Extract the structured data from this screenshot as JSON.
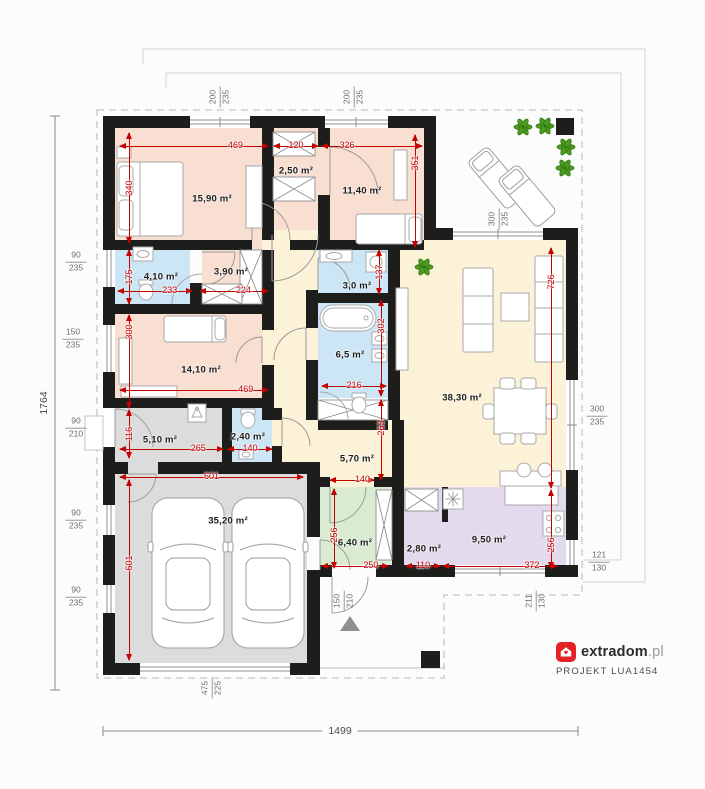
{
  "branding": {
    "name_bold": "extradom",
    "name_light": ".pl",
    "project": "PROJEKT LUA1454"
  },
  "overall": {
    "height": "1764",
    "width": "1499"
  },
  "colors": {
    "wall": "#1d1d1b",
    "dim_red": "#c40000",
    "label_gray": "#6e6e6e",
    "pink": "#f9ded2",
    "blue": "#cde6f6",
    "cream": "#fbf2d8",
    "gray": "#dcdcdc",
    "green": "#d9ecd2",
    "purple": "#e3daee",
    "brand_red": "#e32226"
  },
  "rooms": [
    {
      "id": "bedroom-1",
      "label": "15,90 m²",
      "fill": "pink",
      "x": 115,
      "y": 128,
      "w": 150,
      "h": 112,
      "lx": 212,
      "ly": 199
    },
    {
      "id": "wardrobe-1",
      "label": "2,50 m²",
      "fill": "pink",
      "x": 274,
      "y": 128,
      "w": 44,
      "h": 107,
      "lx": 296,
      "ly": 171
    },
    {
      "id": "bedroom-2",
      "label": "11,40 m²",
      "fill": "pink",
      "x": 318,
      "y": 128,
      "w": 106,
      "h": 112,
      "lx": 362,
      "ly": 191
    },
    {
      "id": "bathroom-1",
      "label": "4,10 m²",
      "fill": "blue",
      "x": 115,
      "y": 250,
      "w": 75,
      "h": 54,
      "lx": 161,
      "ly": 277
    },
    {
      "id": "wardrobe-2",
      "label": "3,90 m²",
      "fill": "pink",
      "x": 202,
      "y": 238,
      "w": 60,
      "h": 66,
      "lx": 231,
      "ly": 272
    },
    {
      "id": "bathroom-2",
      "label": "3,0 m²",
      "fill": "blue",
      "x": 318,
      "y": 250,
      "w": 70,
      "h": 43,
      "lx": 357,
      "ly": 286
    },
    {
      "id": "bedroom-3",
      "label": "14,10 m²",
      "fill": "pink",
      "x": 115,
      "y": 314,
      "w": 147,
      "h": 84,
      "lx": 201,
      "ly": 370
    },
    {
      "id": "bathroom-3",
      "label": "6,5 m²",
      "fill": "blue",
      "x": 318,
      "y": 303,
      "w": 70,
      "h": 95,
      "lx": 350,
      "ly": 355
    },
    {
      "id": "hallway",
      "label": "",
      "fill": "cream",
      "x": 262,
      "y": 230,
      "w": 56,
      "h": 195,
      "lx": 0,
      "ly": 0
    },
    {
      "id": "hall",
      "label": "5,70 m²",
      "fill": "cream",
      "x": 272,
      "y": 420,
      "w": 132,
      "h": 67,
      "lx": 357,
      "ly": 459
    },
    {
      "id": "living-room",
      "label": "38,30 m²",
      "fill": "cream",
      "x": 390,
      "y": 240,
      "w": 176,
      "h": 247,
      "lx": 462,
      "ly": 398
    },
    {
      "id": "corridor-garage",
      "label": "5,10 m²",
      "fill": "gray",
      "x": 115,
      "y": 408,
      "w": 110,
      "h": 54,
      "lx": 160,
      "ly": 440
    },
    {
      "id": "wc",
      "label": "2,40 m²",
      "fill": "blue",
      "x": 225,
      "y": 408,
      "w": 47,
      "h": 54,
      "lx": 248,
      "ly": 437
    },
    {
      "id": "garage",
      "label": "35,20 m²",
      "fill": "gray",
      "x": 115,
      "y": 462,
      "w": 192,
      "h": 201,
      "lx": 228,
      "ly": 521
    },
    {
      "id": "vestibule",
      "label": "6,40 m²",
      "fill": "green",
      "x": 320,
      "y": 487,
      "w": 78,
      "h": 78,
      "lx": 355,
      "ly": 543
    },
    {
      "id": "pantry",
      "label": "2,80 m²",
      "fill": "purple",
      "x": 404,
      "y": 487,
      "w": 38,
      "h": 78,
      "lx": 424,
      "ly": 549
    },
    {
      "id": "kitchen",
      "label": "9,50 m²",
      "fill": "purple",
      "x": 442,
      "y": 487,
      "w": 124,
      "h": 78,
      "lx": 489,
      "ly": 540
    }
  ],
  "red_dims": [
    {
      "t": "469",
      "o": "h",
      "x": 120,
      "y": 146,
      "l": 148,
      "lp": 78
    },
    {
      "t": "120",
      "o": "h",
      "x": 274,
      "y": 146,
      "l": 44
    },
    {
      "t": "326",
      "o": "h",
      "x": 322,
      "y": 146,
      "l": 100,
      "lp": 25
    },
    {
      "t": "340",
      "o": "v",
      "x": 129,
      "y": 133,
      "l": 110
    },
    {
      "t": "351",
      "o": "v",
      "x": 415,
      "y": 135,
      "l": 112,
      "lp": 25
    },
    {
      "t": "175",
      "o": "v",
      "x": 129,
      "y": 250,
      "l": 54
    },
    {
      "t": "233",
      "o": "h",
      "x": 118,
      "y": 291,
      "l": 74,
      "lp": 70
    },
    {
      "t": "224",
      "o": "h",
      "x": 200,
      "y": 291,
      "l": 68,
      "lp": 64
    },
    {
      "t": "137",
      "o": "v",
      "x": 379,
      "y": 250,
      "l": 44
    },
    {
      "t": "300",
      "o": "v",
      "x": 129,
      "y": 315,
      "l": 93,
      "lp": 18
    },
    {
      "t": "469",
      "o": "h",
      "x": 120,
      "y": 390,
      "l": 148,
      "lp": 85
    },
    {
      "t": "302",
      "o": "v",
      "x": 381,
      "y": 300,
      "l": 96,
      "lp": 27
    },
    {
      "t": "216",
      "o": "h",
      "x": 322,
      "y": 386,
      "l": 64
    },
    {
      "t": "116",
      "o": "v",
      "x": 129,
      "y": 410,
      "l": 48
    },
    {
      "t": "265",
      "o": "h",
      "x": 120,
      "y": 449,
      "l": 103,
      "lp": 76
    },
    {
      "t": "140",
      "o": "h",
      "x": 228,
      "y": 449,
      "l": 44
    },
    {
      "t": "263",
      "o": "v",
      "x": 381,
      "y": 400,
      "l": 80,
      "lp": 35
    },
    {
      "t": "140",
      "o": "h",
      "x": 330,
      "y": 480,
      "l": 44,
      "lp": 74
    },
    {
      "t": "601",
      "o": "h",
      "x": 120,
      "y": 477,
      "l": 183
    },
    {
      "t": "601",
      "o": "v",
      "x": 129,
      "y": 480,
      "l": 180,
      "lp": 46
    },
    {
      "t": "256",
      "o": "v",
      "x": 334,
      "y": 489,
      "l": 79,
      "lp": 58
    },
    {
      "t": "250",
      "o": "h",
      "x": 322,
      "y": 566,
      "l": 66,
      "lp": 74
    },
    {
      "t": "110",
      "o": "h",
      "x": 406,
      "y": 566,
      "l": 34
    },
    {
      "t": "372",
      "o": "h",
      "x": 443,
      "y": 566,
      "l": 114,
      "lp": 78
    },
    {
      "t": "256",
      "o": "v",
      "x": 551,
      "y": 490,
      "l": 78,
      "lp": 70
    },
    {
      "t": "726",
      "o": "v",
      "x": 551,
      "y": 248,
      "l": 240,
      "lp": 14
    }
  ],
  "opening_labels": [
    {
      "a": "200",
      "b": "235",
      "x": 220,
      "y": 97,
      "rot": true
    },
    {
      "a": "200",
      "b": "235",
      "x": 354,
      "y": 97,
      "rot": true
    },
    {
      "a": "300",
      "b": "235",
      "x": 499,
      "y": 219,
      "rot": true
    },
    {
      "a": "90",
      "b": "235",
      "x": 76,
      "y": 262,
      "rot": false
    },
    {
      "a": "150",
      "b": "235",
      "x": 73,
      "y": 339,
      "rot": false
    },
    {
      "a": "90",
      "b": "210",
      "x": 76,
      "y": 428,
      "rot": false
    },
    {
      "a": "90",
      "b": "235",
      "x": 76,
      "y": 520,
      "rot": false
    },
    {
      "a": "90",
      "b": "235",
      "x": 76,
      "y": 597,
      "rot": false
    },
    {
      "a": "300",
      "b": "235",
      "x": 597,
      "y": 416,
      "rot": false
    },
    {
      "a": "121",
      "b": "130",
      "x": 599,
      "y": 562,
      "rot": false
    },
    {
      "a": "211",
      "b": "130",
      "x": 536,
      "y": 601,
      "rot": true
    },
    {
      "a": "150",
      "b": "210",
      "x": 344,
      "y": 601,
      "rot": true
    },
    {
      "a": "475",
      "b": "225",
      "x": 212,
      "y": 688,
      "rot": true
    }
  ]
}
